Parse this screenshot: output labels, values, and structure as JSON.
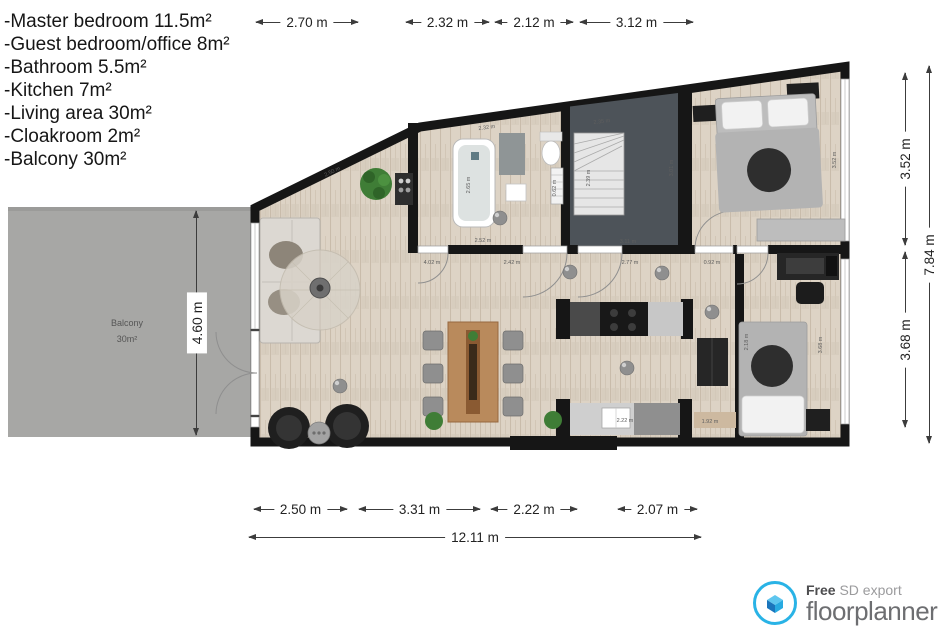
{
  "legend": {
    "items": [
      "-Master bedroom 11.5m²",
      "-Guest bedroom/office 8m²",
      "-Bathroom 5.5m²",
      "-Kitchen 7m²",
      "-Living area 30m²",
      "-Cloakroom 2m²",
      "-Balcony 30m²"
    ]
  },
  "dimensions": {
    "top": [
      "2.70 m",
      "2.32 m",
      "2.12 m",
      "3.12 m"
    ],
    "bottom": [
      "2.50 m",
      "3.31 m",
      "2.22 m",
      "2.07 m"
    ],
    "bottom_total": "12.11 m",
    "right": [
      "3.52 m",
      "3.68 m"
    ],
    "right_total": "7.84 m",
    "left": "4.60 m"
  },
  "plan": {
    "balcony": {
      "name": "Balcony",
      "area": "30m²"
    },
    "micro_dims": [
      "2.50 m",
      "2.32 m",
      "2.65 m",
      "2.52 m",
      "0.62 m",
      "2.35 m",
      "2.39 m",
      "3.11 m",
      "3.01 m",
      "4.02 m",
      "2.42 m",
      "2.77 m",
      "0.92 m",
      "2.22 m",
      "1.92 m",
      "3.52 m",
      "3.68 m",
      "2.18 m"
    ],
    "colors": {
      "wall": "#161616",
      "floor_wood": "#ddd3c5",
      "floor_dark": "#4d5359",
      "balcony_gray": "#a7a7a5",
      "brand_blue": "#29b3e6"
    }
  },
  "footer": {
    "free": "Free",
    "sd_export": "SD export",
    "brand": "floorplanner"
  }
}
